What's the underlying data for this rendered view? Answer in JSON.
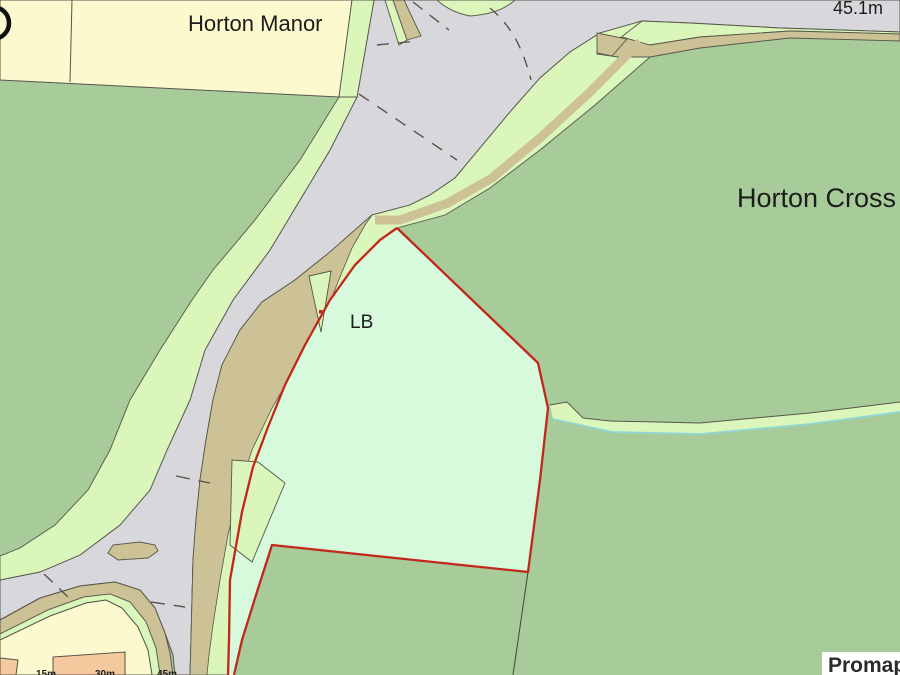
{
  "map": {
    "labels": {
      "horton_manor": "Horton Manor",
      "horton_cross": "Horton Cross",
      "spot_height": "45.1m",
      "letter_box": "LB"
    },
    "scale_ticks": [
      "15m",
      "30m",
      "45m"
    ],
    "branding": {
      "logo": "Promap"
    },
    "colors": {
      "field": "#a7cb99",
      "verge": "#dbf6bb",
      "plot": "#d7f9dc",
      "yellow_land": "#fcf9cf",
      "building": "#f5c99d",
      "track": "#cdc295",
      "road": "#d8d7db",
      "outline": "#56564c",
      "boundary_red": "#c1271b",
      "water": "#8fd8d6",
      "text": "#1c1c1c",
      "logo_bg": "#ffffff",
      "logo_text": "#2b2b28"
    }
  }
}
